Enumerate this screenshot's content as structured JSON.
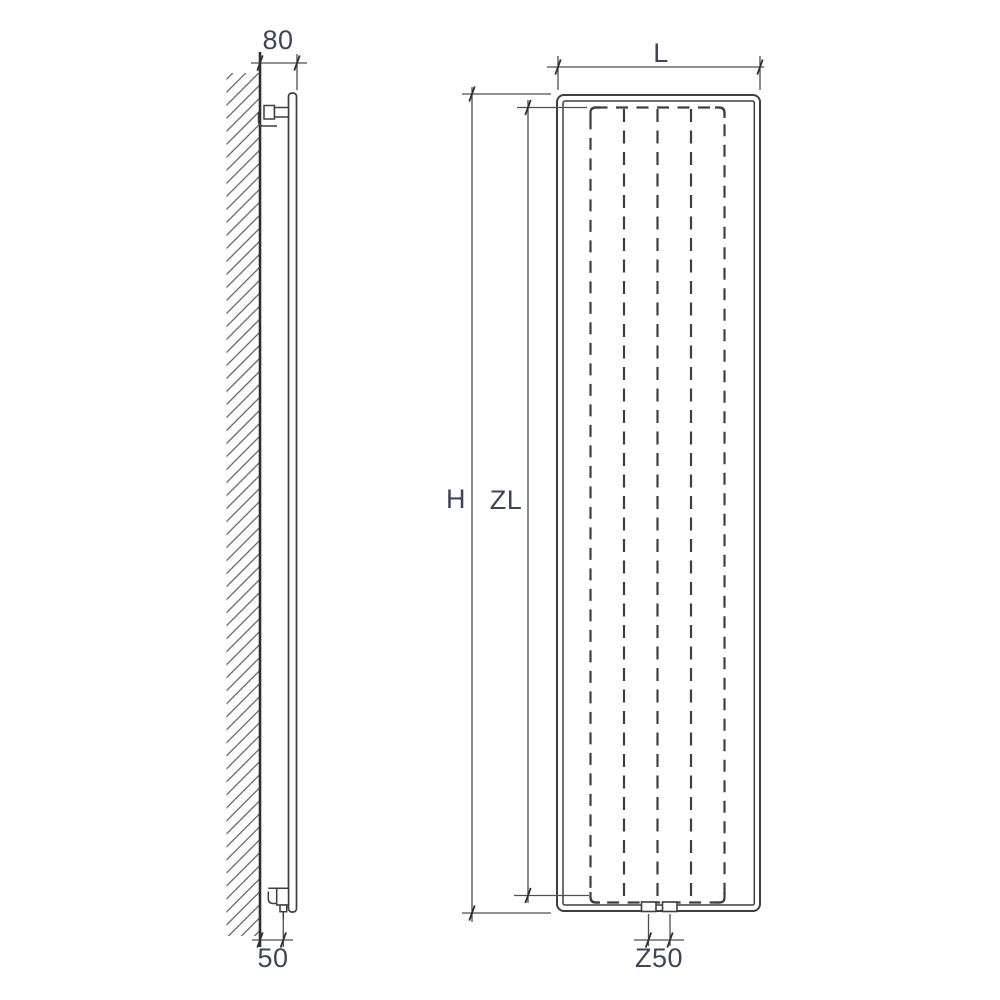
{
  "drawing": {
    "kind": "radiator dimension drawing",
    "side_view": {
      "dim_top": "80",
      "dim_bottom": "50"
    },
    "front_view": {
      "dim_width": "L",
      "dim_height": "H",
      "dim_convector_height": "ZL",
      "dim_connection": "Z50"
    },
    "colors": {
      "background": "#ffffff",
      "line": "#3f3f3f",
      "line_strong": "#2f2f2f",
      "dimension_line": "#4f4f4f",
      "label_text": "#3d4659",
      "hatch": "#555555"
    }
  }
}
